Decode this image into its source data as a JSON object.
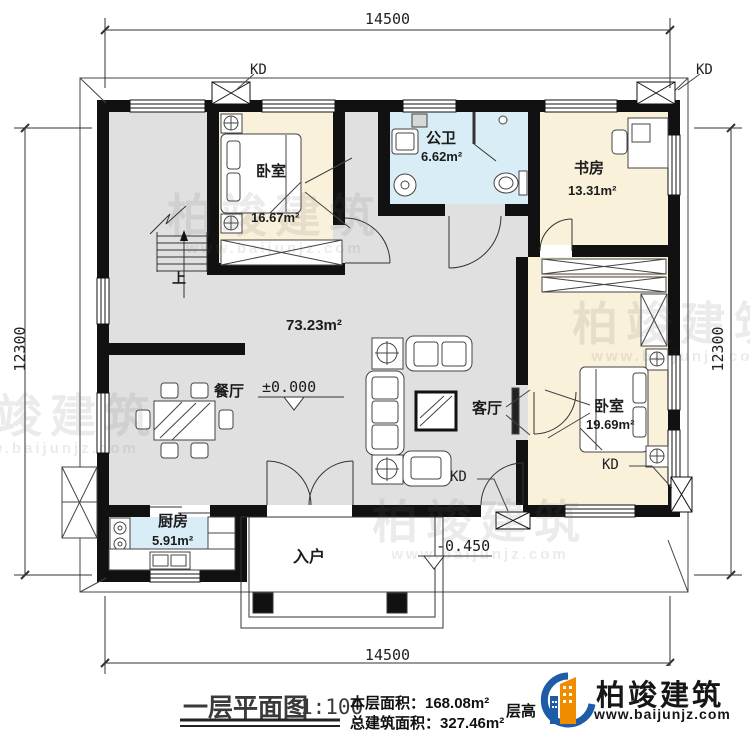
{
  "dimensions": {
    "top": "14500",
    "bottom": "14500",
    "left": "12300",
    "right": "12300"
  },
  "rooms": {
    "bedroom1": {
      "name": "卧室",
      "area": "16.67m²"
    },
    "bathroom": {
      "name": "公卫",
      "area": "6.62m²"
    },
    "study": {
      "name": "书房",
      "area": "13.31m²"
    },
    "hall": {
      "area": "73.23m²",
      "level": "±0.000"
    },
    "dining": {
      "name": "餐厅"
    },
    "living": {
      "name": "客厅"
    },
    "bedroom2": {
      "name": "卧室",
      "area": "19.69m²"
    },
    "kitchen": {
      "name": "厨房",
      "area": "5.91m²"
    },
    "entry": {
      "name": "入户",
      "level": "-0.450"
    }
  },
  "annotations": {
    "kd": "KD",
    "stairs_up": "上"
  },
  "title_block": {
    "drawing_title": "一层平面图",
    "scale": "1:100",
    "floor_area": "本层面积：168.08m²",
    "total_area": "总建筑面积：327.46m²",
    "occluded_text": "层高：3.6",
    "brand_name": "柏竣建筑",
    "brand_site": "www.baijunjz.com"
  },
  "watermark": {
    "name": "柏竣建筑",
    "site": "www.baijunjz.com"
  },
  "colors": {
    "wall": "#111111",
    "room_warm": "#FAF1DA",
    "room_wet": "#D8EDF5",
    "room_hall": "#E0E0E0",
    "brand_blue": "#1E5CA8",
    "brand_orange": "#F08C00"
  }
}
